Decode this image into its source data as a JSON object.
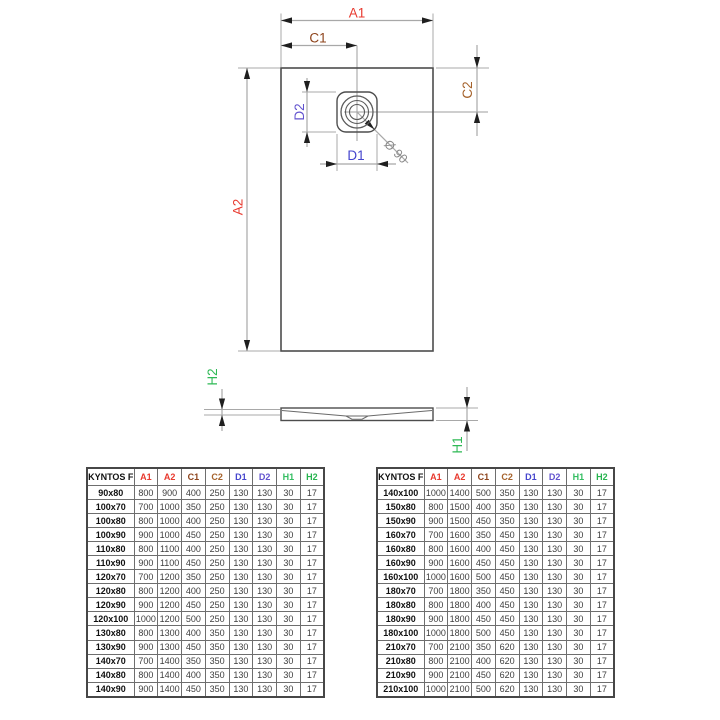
{
  "diagram": {
    "labels": {
      "a1": "A1",
      "a2": "A2",
      "c1": "C1",
      "c2": "C2",
      "d1": "D1",
      "d2": "D2",
      "h1": "H1",
      "h2": "H2",
      "diameter": "Ø 90"
    },
    "colors": {
      "red": "#e8392e",
      "brown_c1": "#8e441c",
      "brown_c2": "#a5622b",
      "blue_d1": "#4545cd",
      "blue_d2": "#6152ce",
      "green_h": "#2eb955",
      "gray_dim": "#8a8a8a"
    }
  },
  "tables": [
    {
      "name_header": "KYNTOS F",
      "columns": [
        {
          "label": "A1",
          "color": "#e8392e"
        },
        {
          "label": "A2",
          "color": "#e8392e"
        },
        {
          "label": "C1",
          "color": "#8e441c"
        },
        {
          "label": "C2",
          "color": "#a5622b"
        },
        {
          "label": "D1",
          "color": "#4545cd"
        },
        {
          "label": "D2",
          "color": "#6152ce"
        },
        {
          "label": "H1",
          "color": "#33bd61"
        },
        {
          "label": "H2",
          "color": "#26b44e"
        }
      ],
      "rows": [
        {
          "name": "90x80",
          "values": [
            800,
            900,
            400,
            250,
            130,
            130,
            30,
            17
          ]
        },
        {
          "name": "100x70",
          "values": [
            700,
            1000,
            350,
            250,
            130,
            130,
            30,
            17
          ]
        },
        {
          "name": "100x80",
          "values": [
            800,
            1000,
            400,
            250,
            130,
            130,
            30,
            17
          ]
        },
        {
          "name": "100x90",
          "values": [
            900,
            1000,
            450,
            250,
            130,
            130,
            30,
            17
          ]
        },
        {
          "name": "110x80",
          "values": [
            800,
            1100,
            400,
            250,
            130,
            130,
            30,
            17
          ]
        },
        {
          "name": "110x90",
          "values": [
            900,
            1100,
            450,
            250,
            130,
            130,
            30,
            17
          ]
        },
        {
          "name": "120x70",
          "values": [
            700,
            1200,
            350,
            250,
            130,
            130,
            30,
            17
          ]
        },
        {
          "name": "120x80",
          "values": [
            800,
            1200,
            400,
            250,
            130,
            130,
            30,
            17
          ]
        },
        {
          "name": "120x90",
          "values": [
            900,
            1200,
            450,
            250,
            130,
            130,
            30,
            17
          ]
        },
        {
          "name": "120x100",
          "values": [
            1000,
            1200,
            500,
            250,
            130,
            130,
            30,
            17
          ]
        },
        {
          "name": "130x80",
          "values": [
            800,
            1300,
            400,
            350,
            130,
            130,
            30,
            17
          ]
        },
        {
          "name": "130x90",
          "values": [
            900,
            1300,
            450,
            350,
            130,
            130,
            30,
            17
          ]
        },
        {
          "name": "140x70",
          "values": [
            700,
            1400,
            350,
            350,
            130,
            130,
            30,
            17
          ]
        },
        {
          "name": "140x80",
          "values": [
            800,
            1400,
            400,
            350,
            130,
            130,
            30,
            17
          ]
        },
        {
          "name": "140x90",
          "values": [
            900,
            1400,
            450,
            350,
            130,
            130,
            30,
            17
          ]
        }
      ]
    },
    {
      "name_header": "KYNTOS F",
      "columns": [
        {
          "label": "A1",
          "color": "#e8392e"
        },
        {
          "label": "A2",
          "color": "#e8392e"
        },
        {
          "label": "C1",
          "color": "#8e441c"
        },
        {
          "label": "C2",
          "color": "#a5622b"
        },
        {
          "label": "D1",
          "color": "#4545cd"
        },
        {
          "label": "D2",
          "color": "#6152ce"
        },
        {
          "label": "H1",
          "color": "#33bd61"
        },
        {
          "label": "H2",
          "color": "#26b44e"
        }
      ],
      "rows": [
        {
          "name": "140x100",
          "values": [
            1000,
            1400,
            500,
            350,
            130,
            130,
            30,
            17
          ]
        },
        {
          "name": "150x80",
          "values": [
            800,
            1500,
            400,
            350,
            130,
            130,
            30,
            17
          ]
        },
        {
          "name": "150x90",
          "values": [
            900,
            1500,
            450,
            350,
            130,
            130,
            30,
            17
          ]
        },
        {
          "name": "160x70",
          "values": [
            700,
            1600,
            350,
            450,
            130,
            130,
            30,
            17
          ]
        },
        {
          "name": "160x80",
          "values": [
            800,
            1600,
            400,
            450,
            130,
            130,
            30,
            17
          ]
        },
        {
          "name": "160x90",
          "values": [
            900,
            1600,
            450,
            450,
            130,
            130,
            30,
            17
          ]
        },
        {
          "name": "160x100",
          "values": [
            1000,
            1600,
            500,
            450,
            130,
            130,
            30,
            17
          ]
        },
        {
          "name": "180x70",
          "values": [
            700,
            1800,
            350,
            450,
            130,
            130,
            30,
            17
          ]
        },
        {
          "name": "180x80",
          "values": [
            800,
            1800,
            400,
            450,
            130,
            130,
            30,
            17
          ]
        },
        {
          "name": "180x90",
          "values": [
            900,
            1800,
            450,
            450,
            130,
            130,
            30,
            17
          ]
        },
        {
          "name": "180x100",
          "values": [
            1000,
            1800,
            500,
            450,
            130,
            130,
            30,
            17
          ]
        },
        {
          "name": "210x70",
          "values": [
            700,
            2100,
            350,
            620,
            130,
            130,
            30,
            17
          ]
        },
        {
          "name": "210x80",
          "values": [
            800,
            2100,
            400,
            620,
            130,
            130,
            30,
            17
          ]
        },
        {
          "name": "210x90",
          "values": [
            900,
            2100,
            450,
            620,
            130,
            130,
            30,
            17
          ]
        },
        {
          "name": "210x100",
          "values": [
            1000,
            2100,
            500,
            620,
            130,
            130,
            30,
            17
          ]
        }
      ]
    }
  ]
}
